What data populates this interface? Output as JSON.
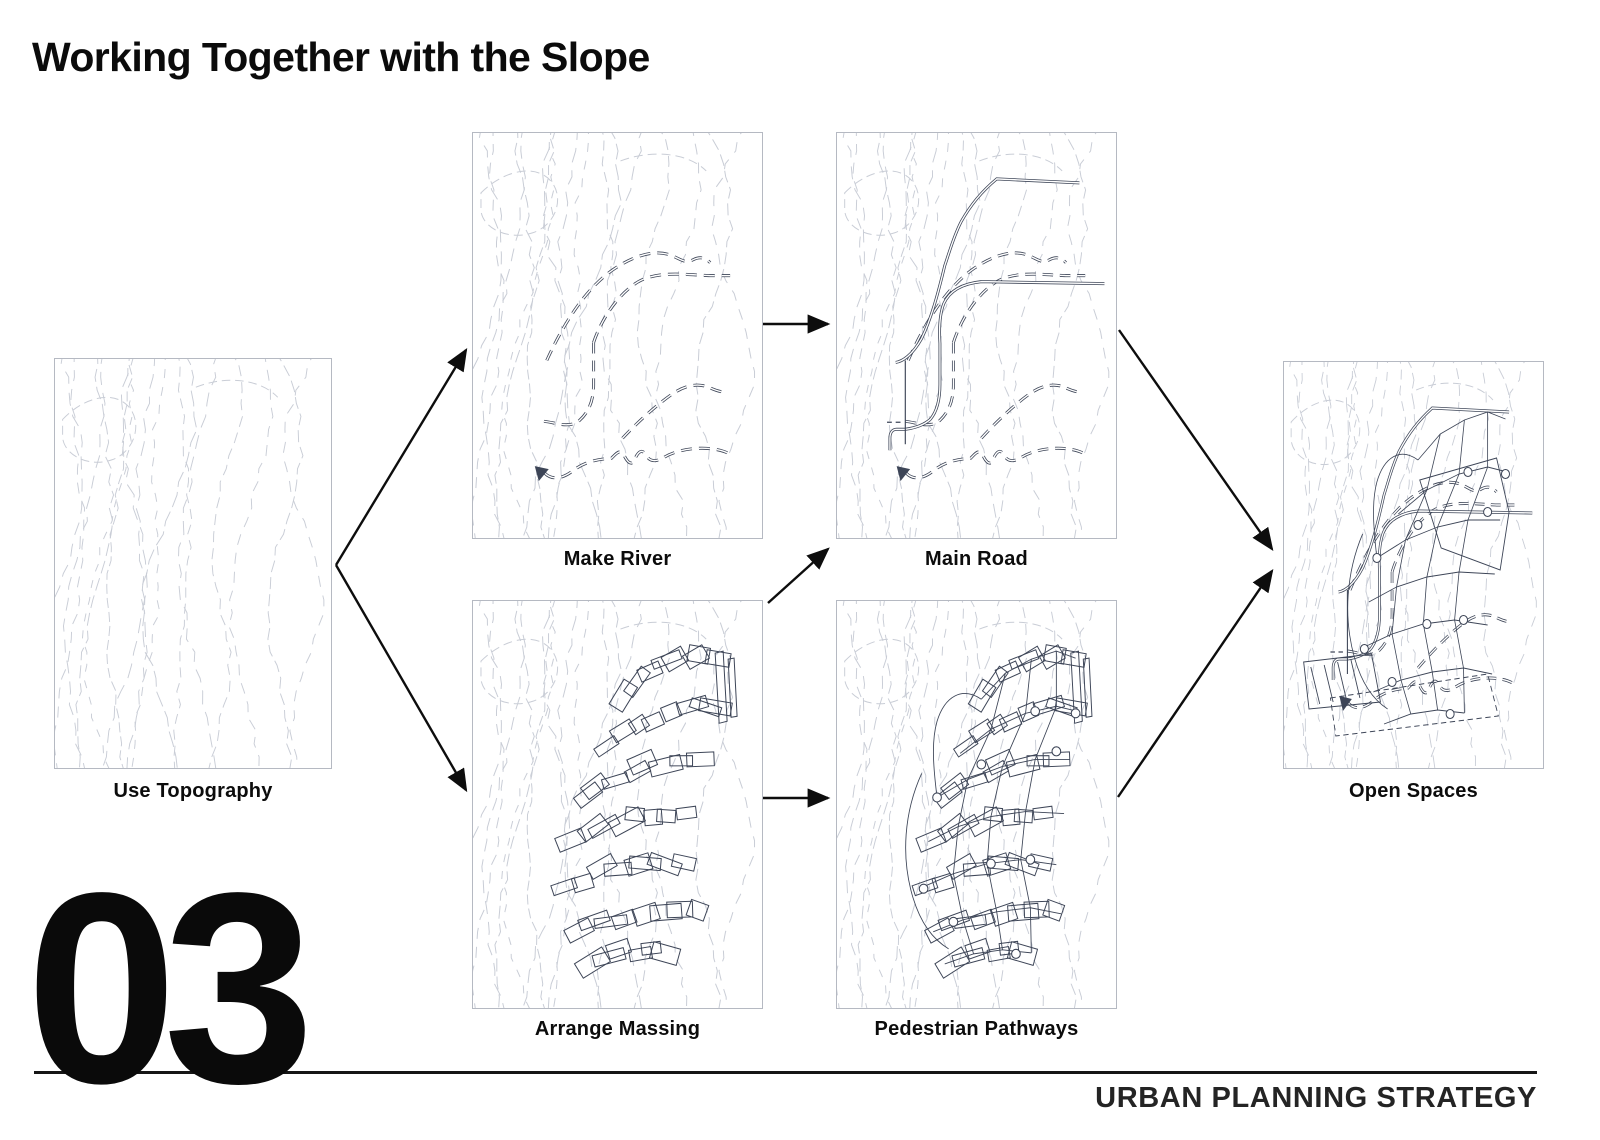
{
  "title": "Working Together with the Slope",
  "page_number": "03",
  "footer_label": "URBAN PLANNING STRATEGY",
  "panels": [
    {
      "id": "use-topography",
      "label": "Use Topography"
    },
    {
      "id": "make-river",
      "label": "Make River"
    },
    {
      "id": "main-road",
      "label": "Main Road"
    },
    {
      "id": "arrange-massing",
      "label": "Arrange Massing"
    },
    {
      "id": "pedestrian-pathways",
      "label": "Pedestrian Pathways"
    },
    {
      "id": "open-spaces",
      "label": "Open Spaces"
    }
  ],
  "flow": [
    {
      "from": "Use Topography",
      "to": "Make River"
    },
    {
      "from": "Use Topography",
      "to": "Arrange Massing"
    },
    {
      "from": "Make River",
      "to": "Main Road"
    },
    {
      "from": "Arrange Massing",
      "to": "Main Road"
    },
    {
      "from": "Arrange Massing",
      "to": "Pedestrian Pathways"
    },
    {
      "from": "Main Road",
      "to": "Open Spaces"
    },
    {
      "from": "Pedestrian Pathways",
      "to": "Open Spaces"
    }
  ],
  "colors": {
    "contour_line": "#c9cdd6",
    "feature_line": "#3d4557",
    "arrow": "#0d0d0d",
    "background": "#ffffff"
  }
}
